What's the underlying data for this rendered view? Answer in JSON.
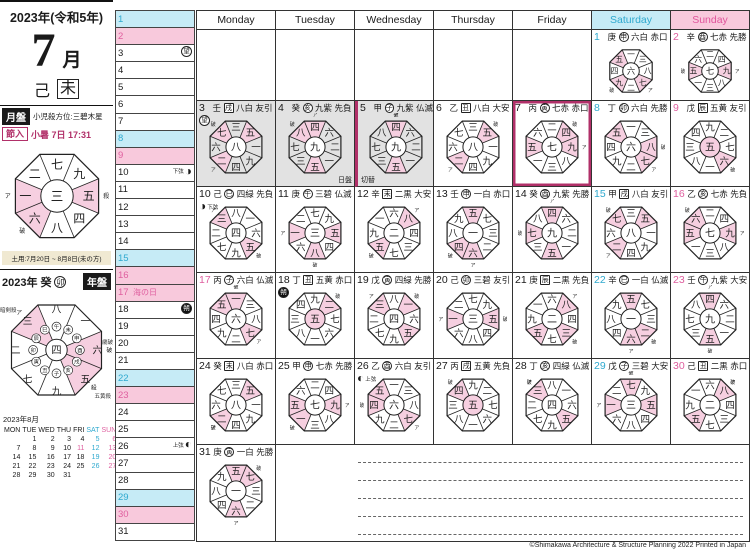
{
  "header": {
    "year_title": "2023年(令和5年)",
    "month_numeral": "7",
    "month_suffix": "月",
    "stem": "己",
    "branch": "未"
  },
  "month_board": {
    "label": "月盤",
    "kosatsu": "小児殺方位:三碧木星",
    "setsu_label": "節入",
    "setsu_text": "小暑 7日 17:31",
    "center": 3,
    "branch": "未",
    "doyo_note": "土用:7月20日 ~ 8月8日(未の方)"
  },
  "year_board": {
    "year_text": "2023年",
    "stem": "癸",
    "branch": "卯",
    "label": "年盤",
    "center": 4,
    "labels": {
      "ankensatsu": "暗剣殺",
      "saiha": "歳破",
      "goousatsu": "五黄殺"
    }
  },
  "weekday_headers": [
    {
      "label": "Monday",
      "kind": "wd"
    },
    {
      "label": "Tuesday",
      "kind": "wd"
    },
    {
      "label": "Wednesday",
      "kind": "wd"
    },
    {
      "label": "Thursday",
      "kind": "wd"
    },
    {
      "label": "Friday",
      "kind": "wd"
    },
    {
      "label": "Saturday",
      "kind": "sat"
    },
    {
      "label": "Sunday",
      "kind": "sun"
    }
  ],
  "days": [
    {
      "d": 1,
      "stem": "庚",
      "branch": "申",
      "star": "六白",
      "rokuyo": "赤口",
      "center": 6
    },
    {
      "d": 2,
      "stem": "辛",
      "branch": "酉",
      "star": "七赤",
      "rokuyo": "先勝",
      "center": 7
    },
    {
      "d": 3,
      "stem": "壬",
      "branch": "戌",
      "star": "八白",
      "rokuyo": "友引",
      "center": 8
    },
    {
      "d": 4,
      "stem": "癸",
      "branch": "亥",
      "star": "九紫",
      "rokuyo": "先負",
      "center": 9
    },
    {
      "d": 5,
      "stem": "甲",
      "branch": "子",
      "star": "九紫",
      "rokuyo": "仏滅",
      "center": 9
    },
    {
      "d": 6,
      "stem": "乙",
      "branch": "丑",
      "star": "八白",
      "rokuyo": "大安",
      "center": 8
    },
    {
      "d": 7,
      "stem": "丙",
      "branch": "寅",
      "star": "七赤",
      "rokuyo": "赤口",
      "center": 7
    },
    {
      "d": 8,
      "stem": "丁",
      "branch": "卯",
      "star": "六白",
      "rokuyo": "先勝",
      "center": 6
    },
    {
      "d": 9,
      "stem": "戊",
      "branch": "辰",
      "star": "五黄",
      "rokuyo": "友引",
      "center": 5
    },
    {
      "d": 10,
      "stem": "己",
      "branch": "巳",
      "star": "四緑",
      "rokuyo": "先負",
      "center": 4
    },
    {
      "d": 11,
      "stem": "庚",
      "branch": "午",
      "star": "三碧",
      "rokuyo": "仏滅",
      "center": 3
    },
    {
      "d": 12,
      "stem": "辛",
      "branch": "未",
      "star": "二黒",
      "rokuyo": "大安",
      "center": 2
    },
    {
      "d": 13,
      "stem": "壬",
      "branch": "申",
      "star": "一白",
      "rokuyo": "赤口",
      "center": 1
    },
    {
      "d": 14,
      "stem": "癸",
      "branch": "酉",
      "star": "九紫",
      "rokuyo": "先勝",
      "center": 9
    },
    {
      "d": 15,
      "stem": "甲",
      "branch": "戌",
      "star": "八白",
      "rokuyo": "友引",
      "center": 8
    },
    {
      "d": 16,
      "stem": "乙",
      "branch": "亥",
      "star": "七赤",
      "rokuyo": "先負",
      "center": 7
    },
    {
      "d": 17,
      "stem": "丙",
      "branch": "子",
      "star": "六白",
      "rokuyo": "仏滅",
      "center": 6
    },
    {
      "d": 18,
      "stem": "丁",
      "branch": "丑",
      "star": "五黄",
      "rokuyo": "赤口",
      "center": 5
    },
    {
      "d": 19,
      "stem": "戊",
      "branch": "寅",
      "star": "四緑",
      "rokuyo": "先勝",
      "center": 4
    },
    {
      "d": 20,
      "stem": "己",
      "branch": "卯",
      "star": "三碧",
      "rokuyo": "友引",
      "center": 3
    },
    {
      "d": 21,
      "stem": "庚",
      "branch": "辰",
      "star": "二黒",
      "rokuyo": "先負",
      "center": 2
    },
    {
      "d": 22,
      "stem": "辛",
      "branch": "巳",
      "star": "一白",
      "rokuyo": "仏滅",
      "center": 1
    },
    {
      "d": 23,
      "stem": "壬",
      "branch": "午",
      "star": "九紫",
      "rokuyo": "大安",
      "center": 9
    },
    {
      "d": 24,
      "stem": "癸",
      "branch": "未",
      "star": "八白",
      "rokuyo": "赤口",
      "center": 8
    },
    {
      "d": 25,
      "stem": "甲",
      "branch": "申",
      "star": "七赤",
      "rokuyo": "先勝",
      "center": 7
    },
    {
      "d": 26,
      "stem": "乙",
      "branch": "酉",
      "star": "六白",
      "rokuyo": "友引",
      "center": 6
    },
    {
      "d": 27,
      "stem": "丙",
      "branch": "戌",
      "star": "五黄",
      "rokuyo": "先負",
      "center": 5
    },
    {
      "d": 28,
      "stem": "丁",
      "branch": "亥",
      "star": "四緑",
      "rokuyo": "仏滅",
      "center": 4
    },
    {
      "d": 29,
      "stem": "戊",
      "branch": "子",
      "star": "三碧",
      "rokuyo": "大安",
      "center": 3
    },
    {
      "d": 30,
      "stem": "己",
      "branch": "丑",
      "star": "二黒",
      "rokuyo": "赤口",
      "center": 2
    },
    {
      "d": 31,
      "stem": "庚",
      "branch": "寅",
      "star": "一白",
      "rokuyo": "先勝",
      "center": 1
    }
  ],
  "specials": {
    "holidays": {
      "17": "海の日"
    },
    "moons": {
      "3": {
        "type": "full",
        "glyph": "望"
      },
      "10": {
        "type": "last-quarter",
        "glyph": "◑",
        "label": "下弦"
      },
      "18": {
        "type": "new",
        "glyph": "朔"
      },
      "26": {
        "type": "first-quarter",
        "glyph": "◐",
        "label": "上弦"
      }
    },
    "gray_days": [
      3,
      4,
      5
    ],
    "setsu_day": 7,
    "kirikae_between": [
      4,
      5
    ],
    "kirikae_caption": [
      "日盤",
      "切替"
    ],
    "box_branches": [
      "丑",
      "辰",
      "未",
      "戌"
    ]
  },
  "mini_calendar": {
    "title": "2023年8月",
    "day_headers": [
      "MON",
      "TUE",
      "WED",
      "THU",
      "FRI",
      "SAT",
      "SUN"
    ],
    "weeks": [
      [
        "",
        "1",
        "2",
        "3",
        "4",
        "5",
        "6"
      ],
      [
        "7",
        "8",
        "9",
        "10",
        "11",
        "12",
        "13"
      ],
      [
        "14",
        "15",
        "16",
        "17",
        "18",
        "19",
        "20"
      ],
      [
        "21",
        "22",
        "23",
        "24",
        "25",
        "26",
        "27"
      ],
      [
        "28",
        "29",
        "30",
        "31",
        "",
        "",
        ""
      ]
    ],
    "holidays": [
      "11"
    ]
  },
  "colors": {
    "sat_bg": "#c6ebf6",
    "sat_text": "#2fa9cf",
    "sun_bg": "#f8c9dc",
    "sun_text": "#df5f9f",
    "accent_magenta": "#b13069",
    "pink_wedge": "#f6cfe0",
    "gray_cell": "#e2e2e2",
    "note_beige": "#f0e9d2"
  },
  "footer": {
    "copyright": "©Shimakawa Architecture & Structure Planning 2022 Printed in Japan"
  }
}
